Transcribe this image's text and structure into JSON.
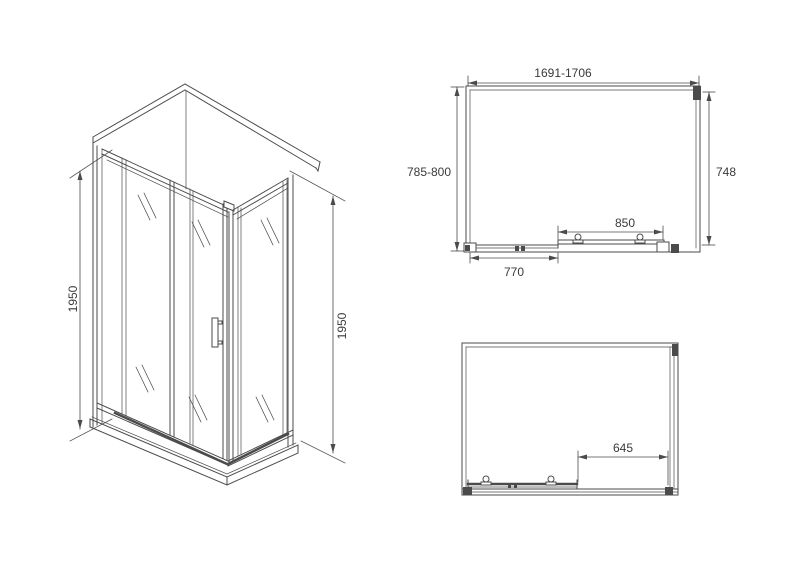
{
  "colors": {
    "line": "#4b4b4b",
    "text": "#3a3a3a",
    "background": "#ffffff"
  },
  "iso_view": {
    "height_left": "1950",
    "height_right": "1950"
  },
  "plan_view_top": {
    "overall_width": "1691-1706",
    "depth": "785-800",
    "side_panel_width": "748",
    "door_width": "850",
    "fixed_panel_width": "770"
  },
  "plan_view_bottom": {
    "opening_width": "645"
  }
}
